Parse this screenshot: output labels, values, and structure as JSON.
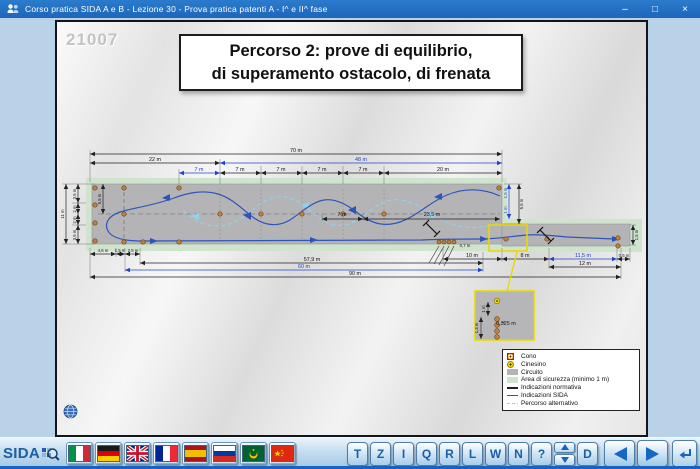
{
  "titlebar": {
    "title": "Corso pratica SIDA A e B - Lezione 30 - Prova pratica patenti A - I^ e II^ fase",
    "minimize": "–",
    "maximize": "□",
    "close": "×"
  },
  "slide": {
    "number": "21007",
    "title_line1": "Percorso 2: prove di equilibrio,",
    "title_line2": "di superamento ostacolo, di frenata"
  },
  "dims": {
    "w70": "70 m",
    "w22": "22 m",
    "w48": "48 m",
    "w7": "7 m",
    "w20": "20 m",
    "h11": "11 m",
    "h35": "3,5 m",
    "h2": "2 m",
    "h55": "5,5 m",
    "in7": "7 m",
    "in235": "23,5 m",
    "b45": "4,5 m",
    "b15": "1,5 m",
    "b25": "2,5 m",
    "b579": "57,9 m",
    "b60": "60 m",
    "b90": "90 m",
    "b10": "10 m",
    "b8": "8 m",
    "b115": "11,5 m",
    "b05": "0,5 m",
    "b12": "12 m",
    "s15": "1,5 m",
    "s1": "1 m",
    "s55": "5,5 m",
    "e15": "1,5 m",
    "c07": "0,7 m",
    "i1": "1 m",
    "i13": "1,3 m",
    "i0325": "0,325 m"
  },
  "legend": {
    "items": [
      {
        "name": "cono",
        "label": "Cono"
      },
      {
        "name": "cinesino",
        "label": "Cinesino"
      },
      {
        "name": "circuito",
        "label": "Circuito"
      },
      {
        "name": "area-sicurezza",
        "label": "Area di sicurezza (minimo 1 m)"
      },
      {
        "name": "indicazioni-normativa",
        "label": "Indicazioni normativa"
      },
      {
        "name": "indicazioni-sida",
        "label": "Indicazioni SIDA"
      },
      {
        "name": "percorso-alternativo",
        "label": "Percorso alternativo"
      }
    ]
  },
  "toolbar": {
    "logo": "SIDA",
    "flags": [
      "italy",
      "germany",
      "uk",
      "france",
      "spain",
      "russia",
      "crescent",
      "china"
    ],
    "keys": [
      "T",
      "Z",
      "I",
      "Q",
      "R",
      "L",
      "W",
      "N",
      "?"
    ],
    "d_key": "D"
  },
  "colors": {
    "accent_blue": "#1b5fa6",
    "path_blue": "#2f54b8",
    "alt_blue": "#8fd4ee",
    "safety_green": "#cfe3cd",
    "circuit_gray": "#b4b4b6",
    "highlight_yellow": "#e8d800"
  }
}
